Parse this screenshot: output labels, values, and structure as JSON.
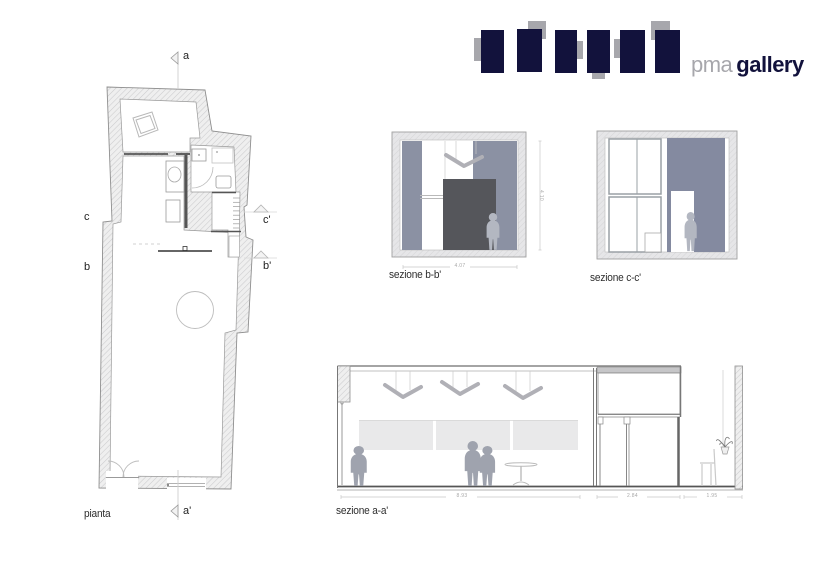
{
  "brand": {
    "pma": "pma",
    "gallery": "gallery"
  },
  "plan": {
    "title": "pianta",
    "markers": {
      "a": "a",
      "a_prime": "a'",
      "b": "b",
      "b_prime": "b'",
      "c": "c",
      "c_prime": "c'"
    }
  },
  "sections": {
    "bb": {
      "title": "sezione b-b'",
      "width_dim": "4.07",
      "height_dim": "4.10"
    },
    "cc": {
      "title": "sezione c-c'"
    },
    "aa": {
      "title": "sezione a-a'",
      "dims": [
        "8.93",
        "2.84",
        "1.95"
      ]
    }
  },
  "colors": {
    "navy": "#12123c",
    "logo_gray": "#a7a7ac",
    "slate": "#8b91a3",
    "slate_dark": "#848aa0",
    "box_dark": "#55565b",
    "figure": "#b3b7c1",
    "figure_dark": "#9fa3ae"
  }
}
